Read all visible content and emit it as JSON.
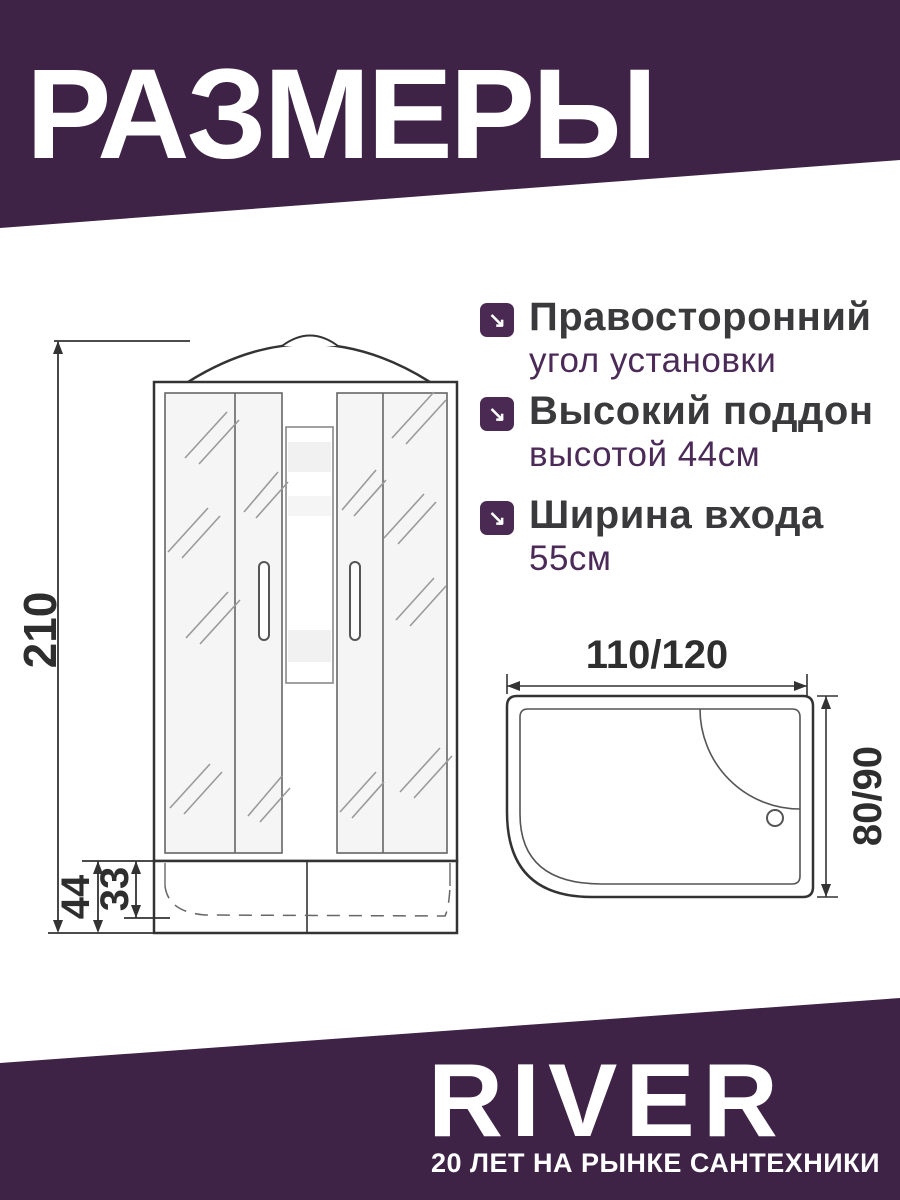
{
  "header": {
    "title": "РАЗМЕРЫ"
  },
  "features": [
    {
      "icon": "↘",
      "title": "Правосторонний",
      "subtitle": "угол установки"
    },
    {
      "icon": "↘",
      "title": "Высокий поддон",
      "subtitle": "высотой 44см"
    },
    {
      "icon": "↘",
      "title": "Ширина входа",
      "subtitle": "55см"
    }
  ],
  "front_view": {
    "height": "210",
    "tray_height": "44",
    "basin_height": "33"
  },
  "top_view": {
    "width": "110/120",
    "depth": "80/90"
  },
  "footer": {
    "brand": "RIVER",
    "tagline": "20 ЛЕТ НА РЫНКЕ САНТЕХНИКИ"
  },
  "colors": {
    "banner_purple": "#3E2347",
    "icon_purple": "#4A2A52",
    "title_gray": "#3A3A3C",
    "subtitle_purple": "#4B2A57",
    "line_dark": "#333333"
  }
}
